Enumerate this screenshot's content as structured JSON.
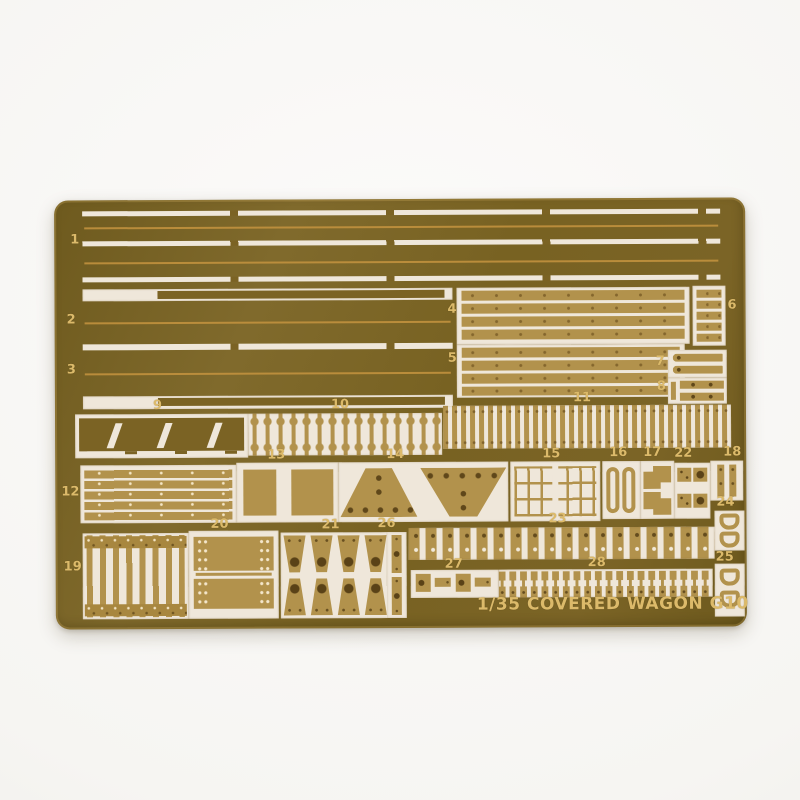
{
  "photo": {
    "alt": "Photo-etched brass detail fret on white background"
  },
  "plate": {
    "etched_text": "1/35 COVERED WAGON G10",
    "part_labels": [
      "1",
      "2",
      "3",
      "4",
      "5",
      "6",
      "7",
      "8",
      "9",
      "10",
      "11",
      "12",
      "13",
      "14",
      "15",
      "16",
      "17",
      "18",
      "19",
      "20",
      "21",
      "22",
      "23",
      "24",
      "25",
      "26",
      "27",
      "28"
    ],
    "colors": {
      "plate": "#7b6324",
      "plate2": "#6f5a1e",
      "cutout": "#efe7da",
      "brass": "#b2924c",
      "brassdark": "#a8873f",
      "etchline": "#c1913e",
      "label": "#dcba6a",
      "bg": "#f6f5f2"
    }
  }
}
